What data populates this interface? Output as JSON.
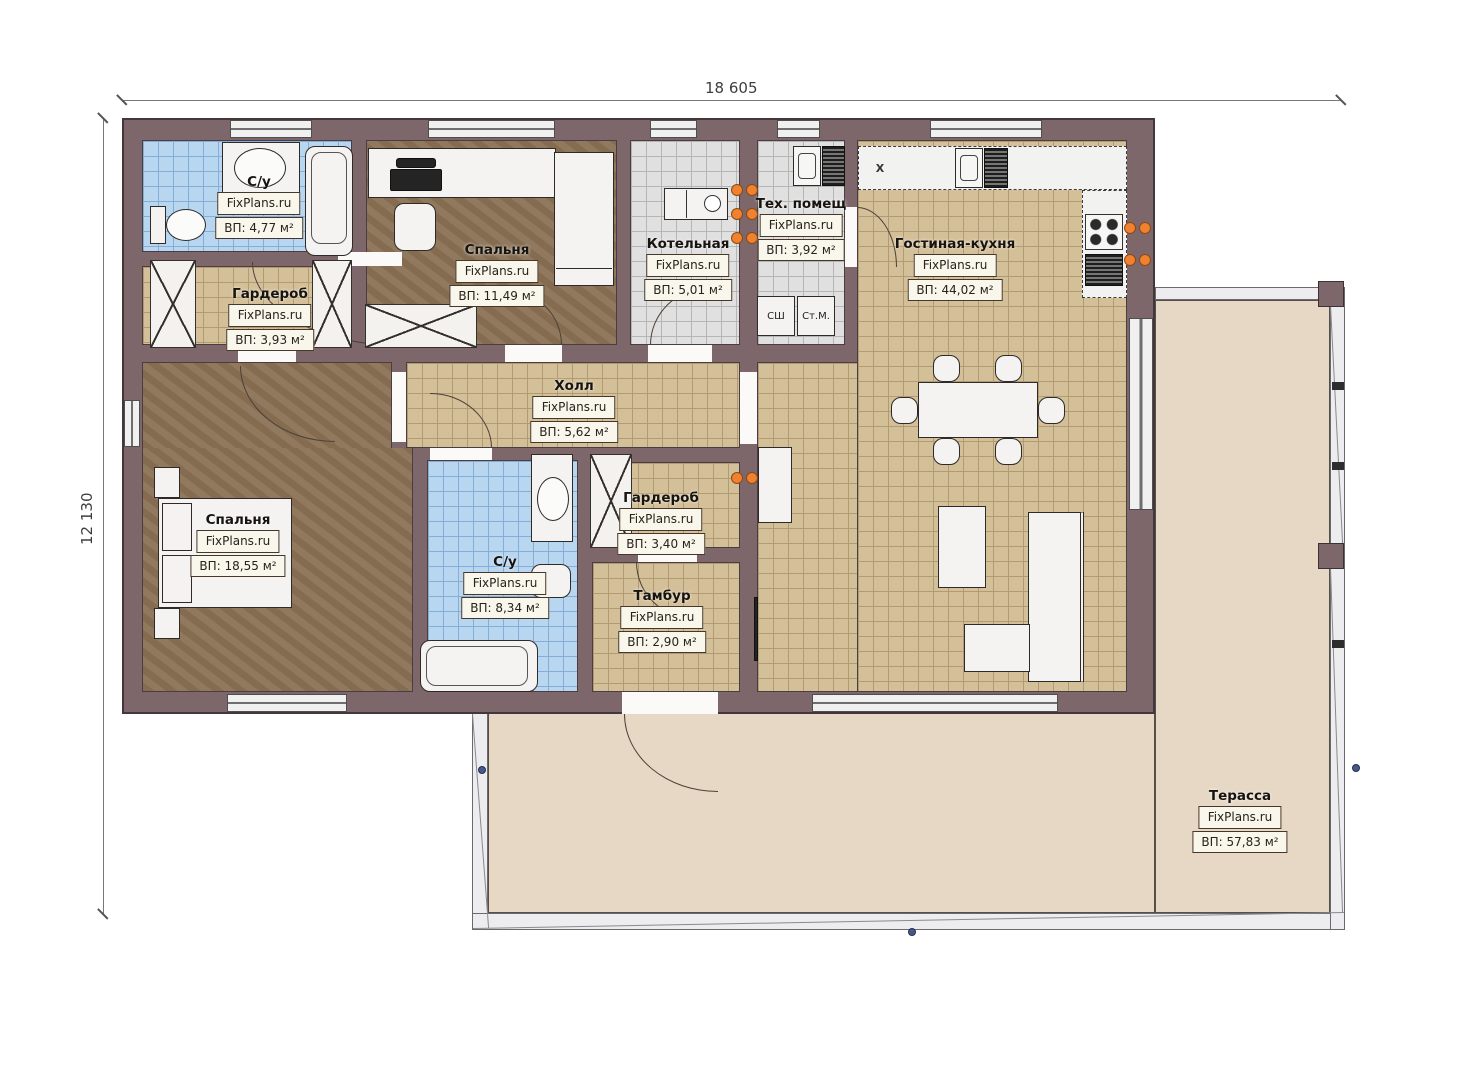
{
  "watermark": "FixPlans.ru",
  "dimensions": {
    "width": "18 605",
    "height": "12 130"
  },
  "rooms": {
    "su1": {
      "name": "С/у",
      "area": "ВП: 4,77 м²"
    },
    "garderob1": {
      "name": "Гардероб",
      "area": "ВП: 3,93 м²"
    },
    "bedroom1": {
      "name": "Спальня",
      "area": "ВП: 11,49 м²"
    },
    "boiler": {
      "name": "Котельная",
      "area": "ВП: 5,01 м²"
    },
    "tech": {
      "name": "Тех. помещ",
      "area": "ВП: 3,92 м²"
    },
    "living": {
      "name": "Гостиная-кухня",
      "area": "ВП: 44,02 м²"
    },
    "hall": {
      "name": "Холл",
      "area": "ВП: 5,62 м²"
    },
    "garderob2": {
      "name": "Гардероб",
      "area": "ВП: 3,40 м²"
    },
    "bedroom2": {
      "name": "Спальня",
      "area": "ВП: 18,55 м²"
    },
    "su2": {
      "name": "С/у",
      "area": "ВП: 8,34 м²"
    },
    "tambur": {
      "name": "Тамбур",
      "area": "ВП: 2,90 м²"
    },
    "terrace": {
      "name": "Терасса",
      "area": "ВП: 57,83 м²"
    }
  },
  "appliances": {
    "dryer_closet": "СШ",
    "washing_machine": "Ст.М.",
    "fridge": "X"
  },
  "colors": {
    "wall": "#7e676b",
    "floor_tan": "#d3bf98",
    "floor_blue": "#b8d6f0",
    "floor_gray": "#e0e0e0",
    "floor_brown": "#8b7256",
    "terrace": "#e6d8c5",
    "radiator": "#ef8130"
  }
}
